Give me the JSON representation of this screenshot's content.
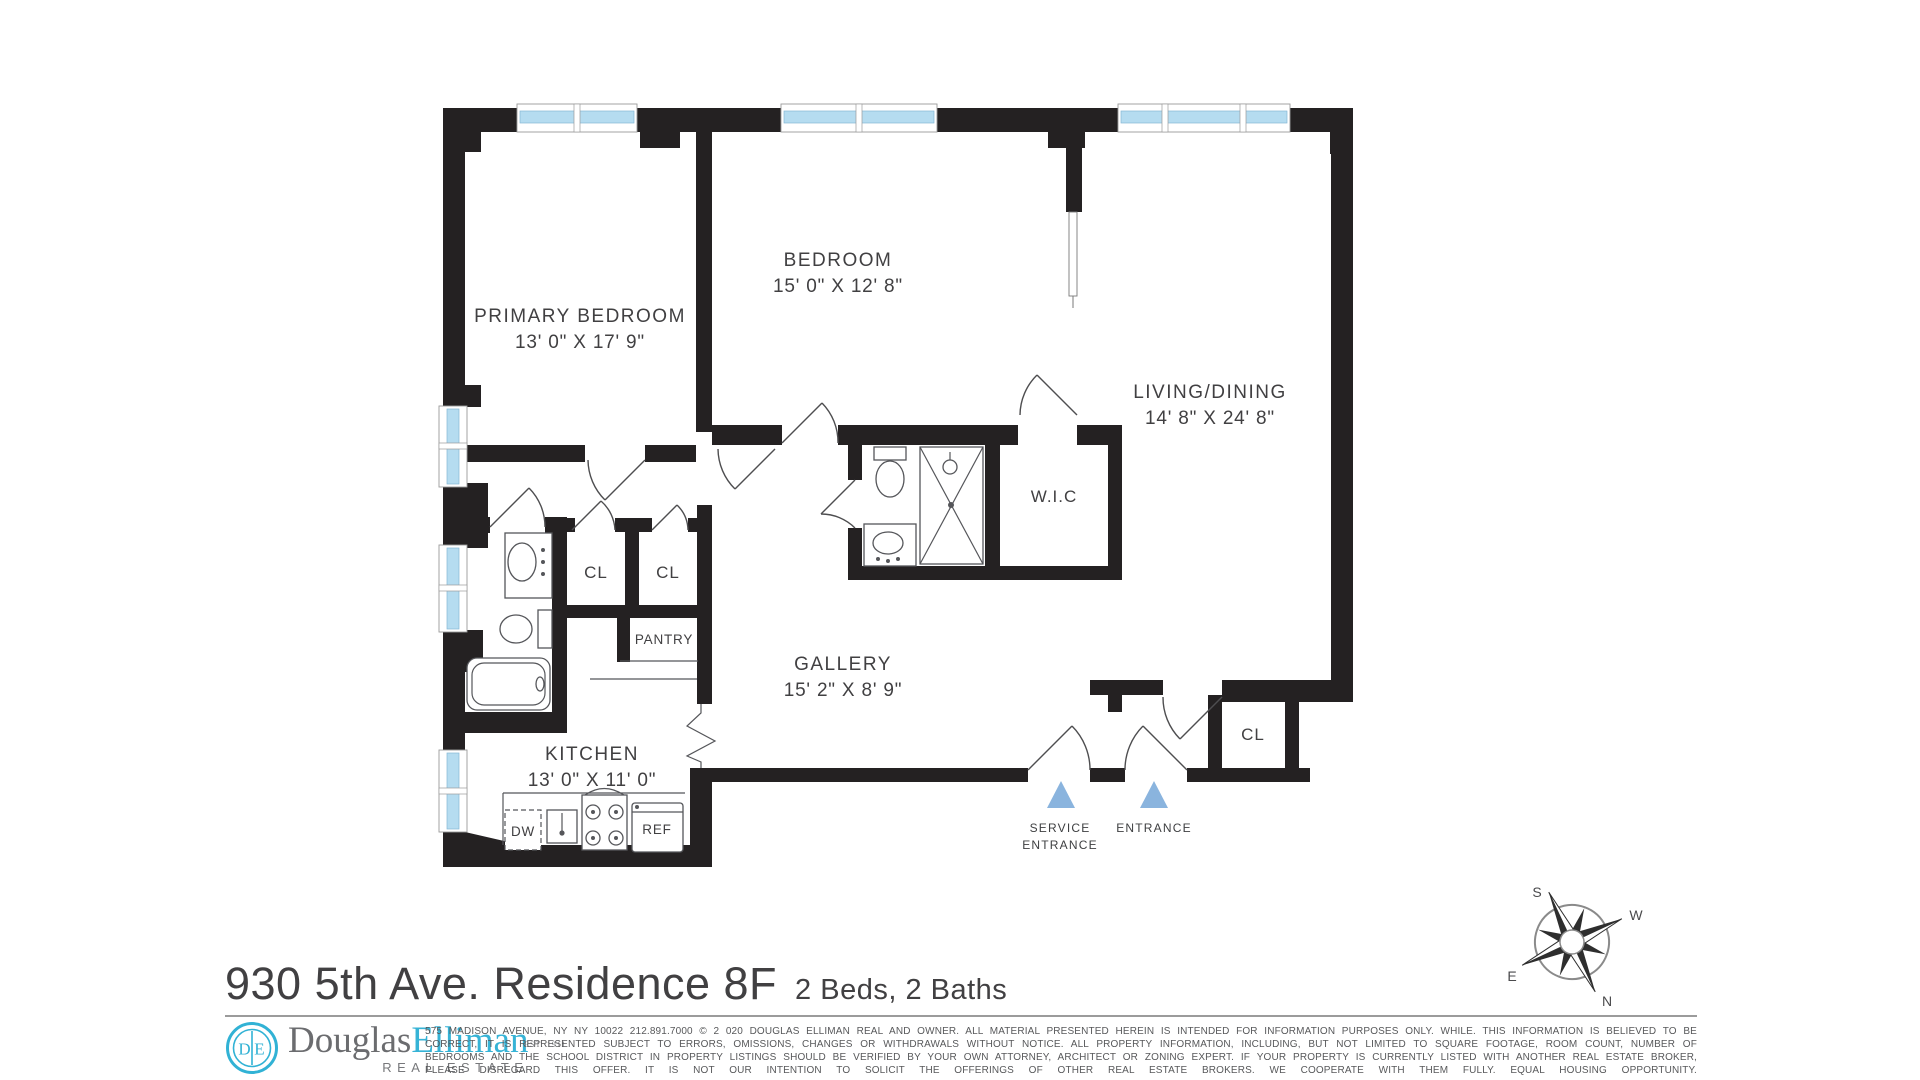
{
  "floor_plan": {
    "rooms": [
      {
        "name": "PRIMARY BEDROOM",
        "dims": "13' 0\" X 17' 9\""
      },
      {
        "name": "BEDROOM",
        "dims": "15' 0\" X 12' 8\""
      },
      {
        "name": "LIVING/DINING",
        "dims": "14' 8\" X 24' 8\""
      },
      {
        "name": "W.I.C",
        "dims": ""
      },
      {
        "name": "GALLERY",
        "dims": "15' 2\" X 8' 9\""
      },
      {
        "name": "KITCHEN",
        "dims": "13' 0\" X 11' 0\""
      }
    ],
    "closets": {
      "cl1": "CL",
      "cl2": "CL",
      "entry_cl": "CL",
      "pantry": "PANTRY"
    },
    "appliances": {
      "dishwasher": "DW",
      "refrigerator": "REF"
    },
    "entrances": {
      "service_line1": "SERVICE",
      "service_line2": "ENTRANCE",
      "main": "ENTRANCE"
    },
    "compass": {
      "n": "N",
      "s": "S",
      "e": "E",
      "w": "W"
    },
    "colors": {
      "wall": "#242122",
      "window_glass": "#b5dcf0",
      "entrance_arrow": "#8ab4de"
    }
  },
  "title": {
    "address": "930 5th Ave. Residence 8F",
    "beds_baths": "2 Beds, 2 Baths"
  },
  "footer": {
    "logo": {
      "monogram": "DE",
      "brand_first": "Douglas",
      "brand_second": "Elliman",
      "established": "EST. 1911",
      "tagline": "REAL ESTATE"
    },
    "disclaimer_lines": [
      "575 MADISON AVENUE, NY NY 10022 212.891.7000 © 2 020 DOUGLAS ELLIMAN REAL AND OWNER. ALL MATERIAL PRESENTED HEREIN IS INTENDED FOR INFORMATION PURPOSES ONLY. WHILE. THIS INFORMATION IS BELIEVED TO BE",
      "CORRECT, IT IS REPRESENTED SUBJECT TO ERRORS, OMISSIONS, CHANGES OR WITHDRAWALS WITHOUT NOTICE. ALL PROPERTY INFORMATION, INCLUDING, BUT NOT LIMITED TO SQUARE FOOTAGE, ROOM COUNT, NUMBER OF",
      "BEDROOMS AND THE SCHOOL DISTRICT IN PROPERTY LISTINGS SHOULD BE VERIFIED BY YOUR OWN ATTORNEY, ARCHITECT OR ZONING EXPERT. IF YOUR PROPERTY IS CURRENTLY LISTED WITH ANOTHER REAL ESTATE BROKER,",
      "PLEASE DISREGARD THIS OFFER. IT IS NOT OUR INTENTION TO SOLICIT THE OFFERINGS OF OTHER REAL ESTATE BROKERS. WE COOPERATE WITH THEM FULLY. EQUAL HOUSING OPPORTUNITY."
    ]
  }
}
